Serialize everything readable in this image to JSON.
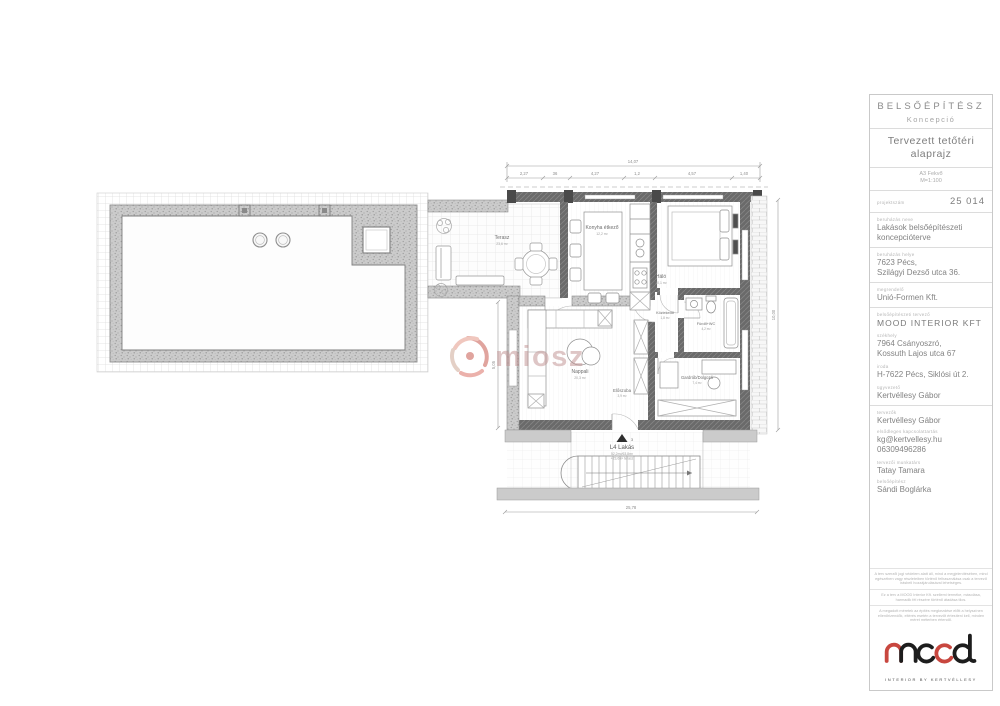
{
  "title_block": {
    "discipline": "BELSŐÉPÍTÉSZ",
    "phase": "Koncepció",
    "drawing_title": "Tervezett tetőtéri alaprajz",
    "paper": "A3 Fekvő",
    "scale": "M=1:100",
    "project_number_label": "projektszám",
    "project_number": "25 014",
    "project_name_label": "beruházás neve",
    "project_name": "Lakások belsőépítészeti koncepcióterve",
    "location_label": "beruházás helye",
    "location_line1": "7623 Pécs,",
    "location_line2": "Szilágyi Dezső utca 36.",
    "client_label": "megrendelő",
    "client": "Unió-Formen Kft.",
    "designer_label": "belsőépítészeti tervező",
    "designer": "MOOD INTERIOR KFT",
    "hq_label": "székhely",
    "hq_line1": "7964 Csányoszró,",
    "hq_line2": "Kossuth Lajos utca 67",
    "office_label": "iroda",
    "office": "H-7622 Pécs, Siklósi út 2.",
    "ceo_label": "ügyvezető",
    "ceo": "Kertvéllesy Gábor",
    "planners_label": "tervezők",
    "planner": "Kertvéllesy Gábor",
    "contact_label": "elsődleges kapcsolattartás",
    "email": "kg@kertvellesy.hu",
    "phone": "06309496286",
    "associate_label": "tervezői munkatárs",
    "associate": "Tatay Tamara",
    "interior_label": "belsőépítész",
    "interior_designer": "Sándi Boglárka",
    "fine_print": [
      "A terv szerzői jogi védelem alatt áll, mind a megjelenítésében, mind egészében vagy részleteiben történő felhasználása csak a tervező írásbeli hozzájárulásával lehetséges.",
      "Ez a terv a MOOD Interior Kft. szellemi terméke, másolása, harmadik fél részére történő átadása tilos.",
      "A megadott méretek az építés megkezdése előtt a helyszínen ellenőrizendők, eltérés esetén a tervezőt értesíteni kell, minden méret méterben értendő."
    ],
    "logo_sub": "INTERIOR BY KERTVÉLLESY",
    "brand_black": "#1d1d1d",
    "brand_red": "#c8473f"
  },
  "plan": {
    "watermark": "miosz",
    "unit": {
      "name": "L4 Lakás",
      "line1": "52,2m²/63,8m²",
      "line2": "+23,6m² terasz"
    },
    "entry_number": "3",
    "rooms": [
      {
        "label": "Terasz",
        "area": "23,6 m²"
      },
      {
        "label": "Konyha étkező",
        "area": "12,2 m²"
      },
      {
        "label": "Háló",
        "area": "10,1 m²"
      },
      {
        "label": "Közlekedő",
        "area": "1,8 m²"
      },
      {
        "label": "Fürdő+WC",
        "area": "4,2 m²"
      },
      {
        "label": "Nappali",
        "area": "20,3 m²"
      },
      {
        "label": "Előszoba",
        "area": "3,9 m²"
      },
      {
        "label": "Gardrób/Dolgozó",
        "area": "7,4 m²"
      }
    ],
    "dimensions": {
      "top_total": "14,07",
      "top_segments": [
        "2,27",
        "36",
        "4,27",
        "1,2",
        "4,57",
        "1,40"
      ],
      "right": "10,00",
      "bottom": "25,78",
      "left": "5,05"
    }
  }
}
